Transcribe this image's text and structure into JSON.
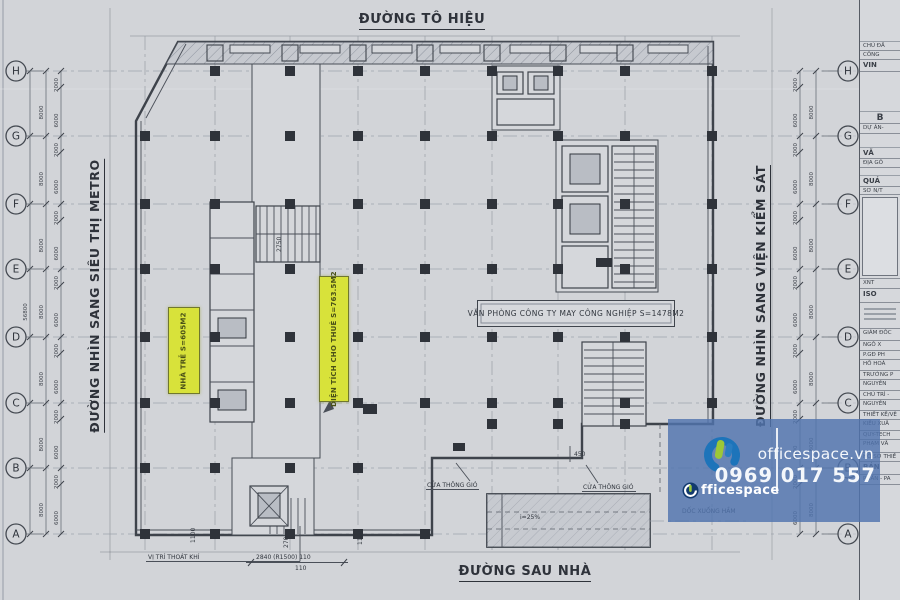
{
  "streets": {
    "top": "ĐƯỜNG TÔ HIỆU",
    "left": "ĐƯỜNG NHÌN SANG SIÊU THỊ METRO",
    "right": "ĐƯỜNG NHÌN SANG VIỆN KIỂM SÁT",
    "bottom": "ĐƯỜNG SAU NHÀ"
  },
  "grid_rows": [
    "H",
    "G",
    "F",
    "E",
    "D",
    "C",
    "B",
    "A"
  ],
  "areas": {
    "office_label": "VĂN PHÒNG CÔNG TY MAY CÔNG NGHIỆP S=1478M2",
    "nursery_label": "NHÀ TRẺ S=605M2",
    "rental_label": "DIỆN TÍCH CHO THUÊ S=763.5M2"
  },
  "annotations": {
    "vent_left": "CỬA THÔNG GIÓ",
    "vent_right": "CỬA THÔNG GIÓ",
    "exhaust": "VỊ TRÍ THOÁT KHÍ",
    "ramp_slope": "i=25%",
    "basement_ramp": "DỐC XUỐNG HẦM",
    "dim_450": "450",
    "dim_2840": "2840 (R1500) 110",
    "dim_110": "110",
    "dim_270": "270",
    "dim_1100a": "1100",
    "dim_1100b": "1100",
    "dim_2750": "2750"
  },
  "dims": {
    "overall": "56800",
    "left": [
      "8000",
      "8000",
      "8000",
      "8000",
      "8000",
      "8000",
      "8000"
    ],
    "right": [
      "8000",
      "8000",
      "8000",
      "8000",
      "8000",
      "8000",
      "8000"
    ],
    "inner": [
      "2000",
      "6000",
      "2000",
      "6000",
      "2000",
      "6000",
      "2000",
      "6000",
      "2000",
      "6000",
      "2000",
      "6000",
      "2000",
      "6000"
    ]
  },
  "watermark": {
    "site": "officespace.vn",
    "phone": "0969 017 557",
    "brand_rest": "fficespace"
  },
  "titleblock": {
    "rows": [
      "CHỦ ĐẦ",
      "CÔNG",
      "VIN",
      "B",
      "DỰ ÁN-",
      "VĂ",
      "ĐỊA GỐ",
      "QUẢ",
      "SƠ N/T",
      "XNT",
      "ISO",
      "GIÁM ĐỐC",
      "NGÔ X",
      "P.GĐ PH",
      "HỒ HOÀ",
      "TRƯỞNG P",
      "NGUYỄN",
      "CHỦ TRÌ -",
      "NGUYỄN",
      "THIẾT KẾ/VẼ",
      "KIỀU XUÂ",
      "QUY-TECH",
      "PHẠM VĂ",
      "HỒ SƠ THIẾ",
      "BẢN",
      "PHẦN - PA"
    ]
  }
}
